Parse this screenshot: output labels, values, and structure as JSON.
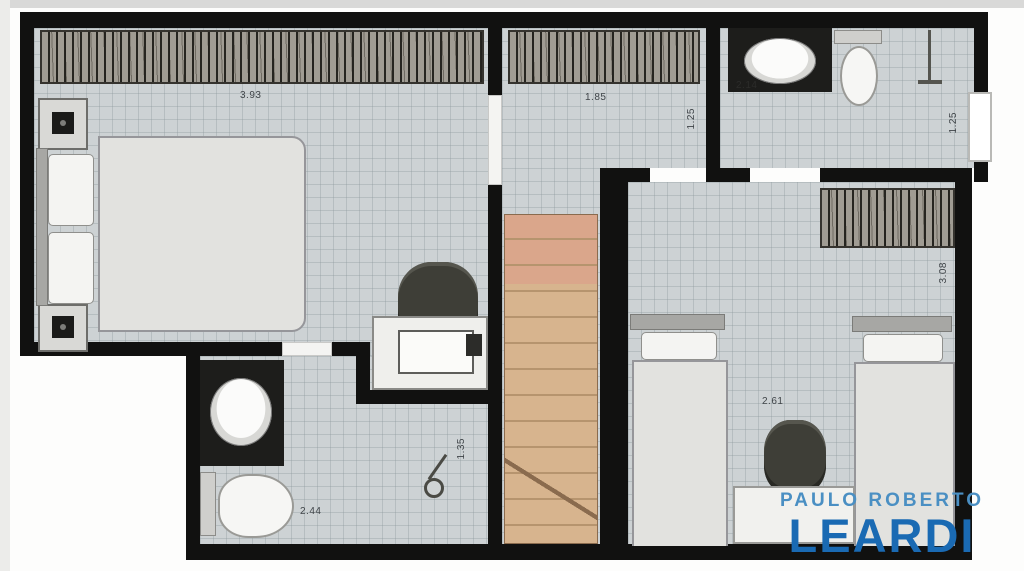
{
  "plan": {
    "type": "floor-plan-upper-storey",
    "colors": {
      "wall": "#111110",
      "floor": "#cdd2d4",
      "stair_wood": "#d7b48e",
      "counter_dark": "#1d1d1b"
    },
    "dimensions": {
      "master_bedroom_width": "3.93",
      "master_bedroom_depth": "3.06",
      "hall_width": "1.85",
      "hall_depth": "1.25",
      "bath_top_width": "2.14",
      "bath_top_depth": "1.25",
      "bedroom2_width": "2.61",
      "bedroom2_depth": "3.08",
      "bath_bottom_width": "2.44",
      "bath_bottom_depth": "1.35"
    },
    "rooms": [
      {
        "name": "master-bedroom",
        "furniture": [
          "wardrobe",
          "double-bed",
          "two-nightstands",
          "desk",
          "chair",
          "laptop"
        ]
      },
      {
        "name": "hall",
        "furniture": [
          "wardrobe"
        ]
      },
      {
        "name": "bathroom-top",
        "furniture": [
          "sink-counter",
          "toilet",
          "shower",
          "window"
        ]
      },
      {
        "name": "staircase",
        "furniture": [
          "wood-steps"
        ]
      },
      {
        "name": "bedroom2",
        "furniture": [
          "wardrobe",
          "single-bed",
          "single-bed",
          "chair",
          "shelf"
        ]
      },
      {
        "name": "bathroom-bottom",
        "furniture": [
          "sink-counter",
          "toilet",
          "shower-head"
        ]
      }
    ]
  },
  "logo": {
    "line1": "PAULO ROBERTO",
    "line2": "LEARDI",
    "line1_color": "#4a8fc3",
    "line2_color": "#1a6ab3"
  }
}
